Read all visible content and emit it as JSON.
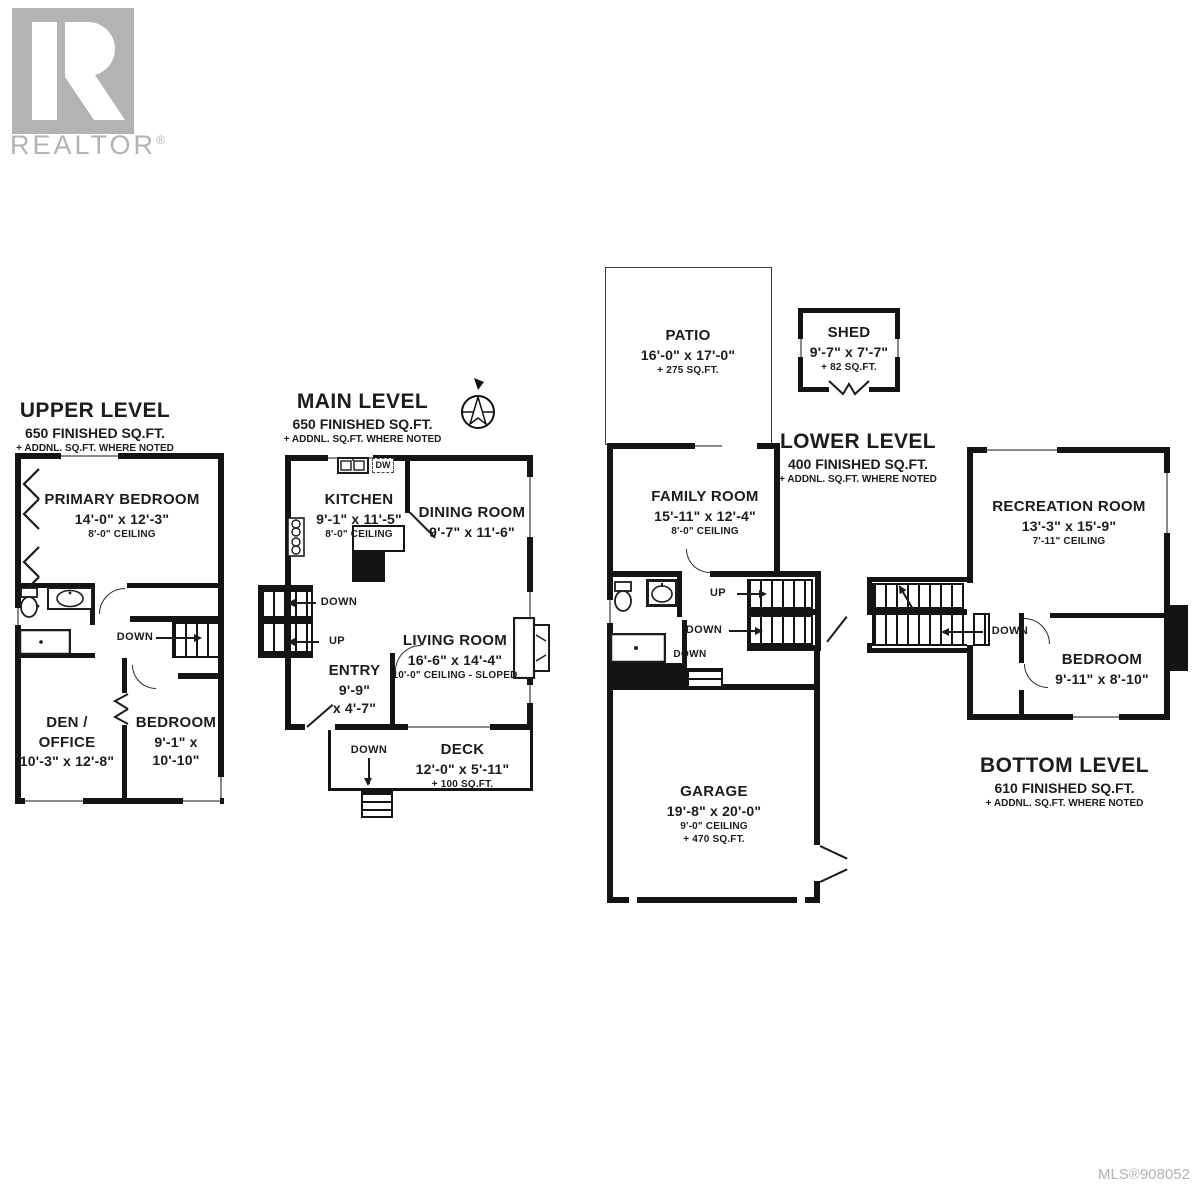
{
  "branding": {
    "logo_text": "REALTOR",
    "reg": "®"
  },
  "footer": {
    "mls": "MLS®908052"
  },
  "compass": {
    "n": "N"
  },
  "stair_labels": {
    "down": "DOWN",
    "up": "UP"
  },
  "levels": {
    "upper": {
      "title": "UPPER LEVEL",
      "subtitle": "650 FINISHED SQ.FT.",
      "note": "+ ADDNL. SQ.FT. WHERE NOTED",
      "primary_bedroom": {
        "name": "PRIMARY BEDROOM",
        "dims": "14'-0\" x 12'-3\"",
        "ceiling": "8'-0\" CEILING"
      },
      "den_office": {
        "name": "DEN / OFFICE",
        "dims": "10'-3\" x 12'-8\""
      },
      "bedroom": {
        "name": "BEDROOM",
        "dims": "9'-1\" x 10'-10\""
      }
    },
    "main": {
      "title": "MAIN LEVEL",
      "subtitle": "650 FINISHED SQ.FT.",
      "note": "+ ADDNL. SQ.FT. WHERE NOTED",
      "kitchen": {
        "name": "KITCHEN",
        "dims": "9'-1\" x 11'-5\"",
        "ceiling": "8'-0\" CEILING"
      },
      "dining_room": {
        "name": "DINING ROOM",
        "dims": "9'-7\" x 11'-6\""
      },
      "living_room": {
        "name": "LIVING ROOM",
        "dims": "16'-6\" x 14'-4\"",
        "ceiling": "10'-0\" CEILING - SLOPED"
      },
      "entry": {
        "name": "ENTRY",
        "dims_a": "9'-9\"",
        "dims_b": "x 4'-7\""
      },
      "deck": {
        "name": "DECK",
        "dims": "12'-0\" x 5'-11\"",
        "area": "+ 100 SQ.FT."
      },
      "dw": "DW"
    },
    "lower": {
      "title": "LOWER LEVEL",
      "subtitle": "400 FINISHED SQ.FT.",
      "note": "+ ADDNL. SQ.FT. WHERE NOTED",
      "family_room": {
        "name": "FAMILY ROOM",
        "dims": "15'-11\" x 12'-4\"",
        "ceiling": "8'-0\" CEILING"
      },
      "garage": {
        "name": "GARAGE",
        "dims": "19'-8\" x 20'-0\"",
        "ceiling": "9'-0\" CEILING",
        "area": "+ 470 SQ.FT."
      }
    },
    "bottom": {
      "title": "BOTTOM LEVEL",
      "subtitle": "610 FINISHED SQ.FT.",
      "note": "+ ADDNL. SQ.FT. WHERE NOTED",
      "recreation_room": {
        "name": "RECREATION ROOM",
        "dims": "13'-3\" x 15'-9\"",
        "ceiling": "7'-11\" CEILING"
      },
      "bedroom": {
        "name": "BEDROOM",
        "dims": "9'-11\" x 8'-10\""
      }
    }
  },
  "outdoor": {
    "patio": {
      "name": "PATIO",
      "dims": "16'-0\" x 17'-0\"",
      "area": "+ 275 SQ.FT."
    },
    "shed": {
      "name": "SHED",
      "dims": "9'-7\" x 7'-7\"",
      "area": "+ 82 SQ.FT."
    }
  },
  "colors": {
    "wall": "#141414",
    "logo_gray": "#b3b3b3",
    "window_line": "#8a8a8a"
  }
}
